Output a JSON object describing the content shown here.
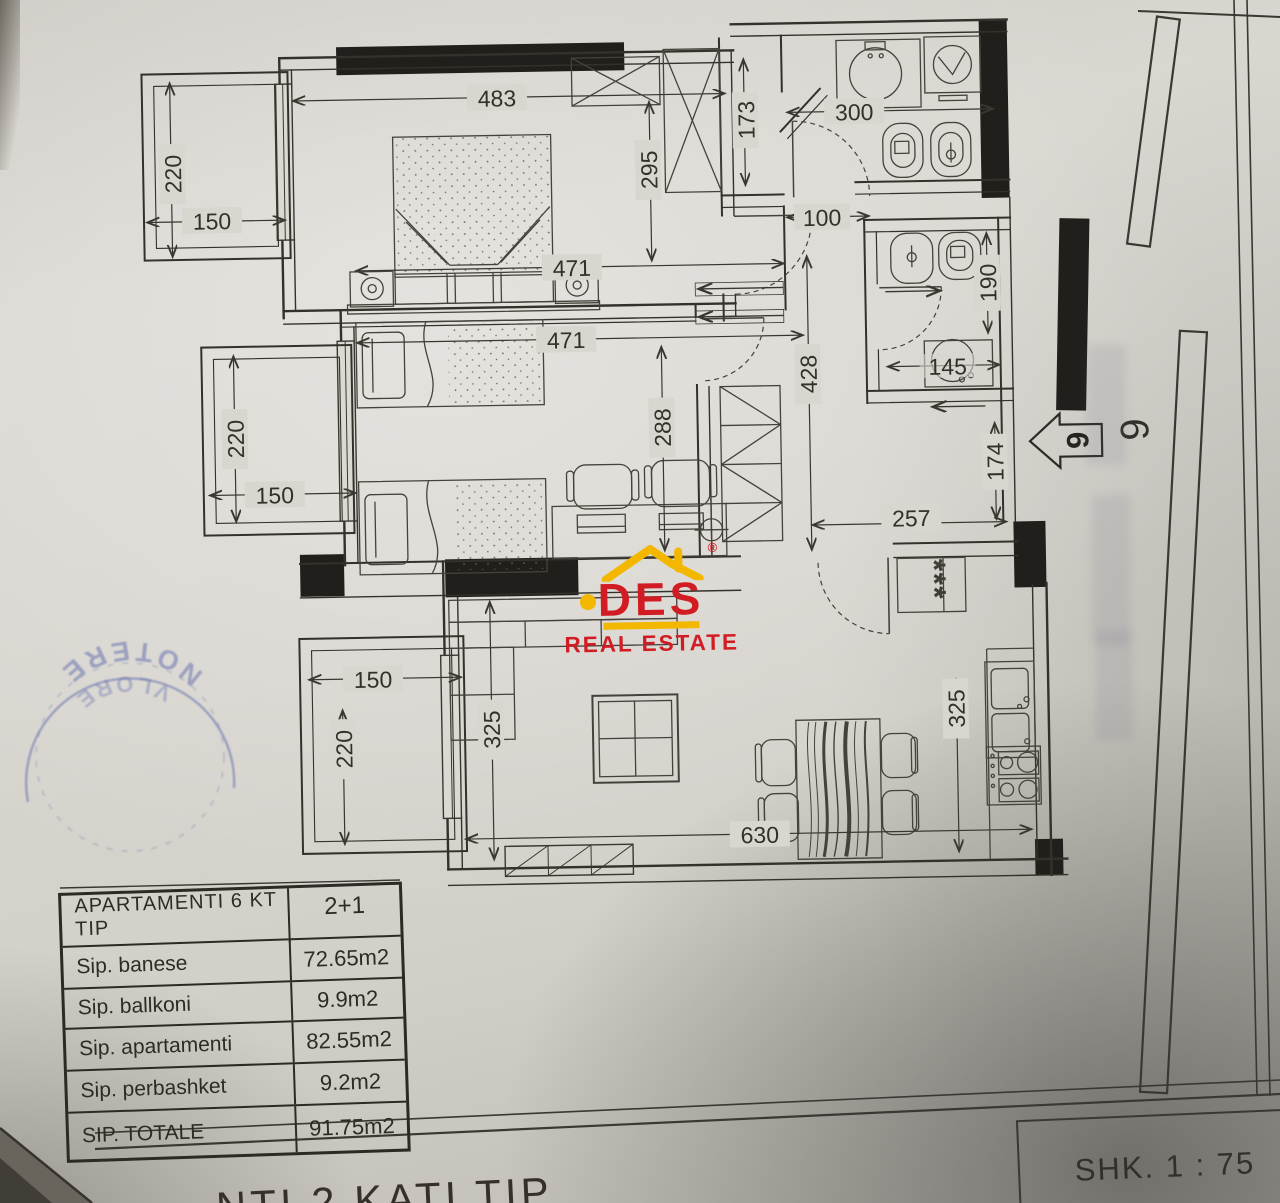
{
  "colors": {
    "logo_red": "#d21c24",
    "logo_yellow": "#f3b700",
    "stamp_blue": "#3f51a3",
    "paper": "#d8d5cf",
    "ink": "#33312c"
  },
  "logo": {
    "brand": "DES",
    "registered": "®",
    "tagline": "REAL ESTATE"
  },
  "plan": {
    "dims": {
      "bedroom_width": "483",
      "bedroom_depth": "295",
      "bedroom_inner": "471",
      "closet_height": "173",
      "bath_width": "300",
      "hall_width": "100",
      "bath2_height": "190",
      "bath2_sink": "145",
      "hall_height": "428",
      "hall_bottom_width": "257",
      "entry_height": "174",
      "kids_width": "471",
      "kids_depth": "288",
      "living_height_left": "325",
      "living_height_right": "325",
      "living_width": "630",
      "balcony_top_w": "150",
      "balcony_top_h": "220",
      "balcony_mid_w": "150",
      "balcony_mid_h": "220",
      "balcony_bot_w": "150",
      "balcony_bot_h": "220"
    },
    "symbols": {
      "fridge_marks": "***",
      "unit_number_arrow": "6",
      "unit_number_side": "6"
    }
  },
  "stamp": {
    "line_top": "NOTERE",
    "line_bottom": "VLORE"
  },
  "area_table": {
    "header": {
      "label": "APARTAMENTI 6 KT TIP",
      "value": "2+1"
    },
    "rows": [
      {
        "label": "Sip. banese",
        "value": "72.65m2"
      },
      {
        "label": "Sip. ballkoni",
        "value": "9.9m2"
      },
      {
        "label": "Sip. apartamenti",
        "value": "82.55m2"
      },
      {
        "label": "Sip. perbashket",
        "value": "9.2m2"
      },
      {
        "label": "SIP. TOTALE",
        "value": "91.75m2"
      }
    ]
  },
  "scale_box": {
    "label": "SHK. 1 : 75"
  },
  "caption_fragment": "NTI 2 KATI TIP"
}
